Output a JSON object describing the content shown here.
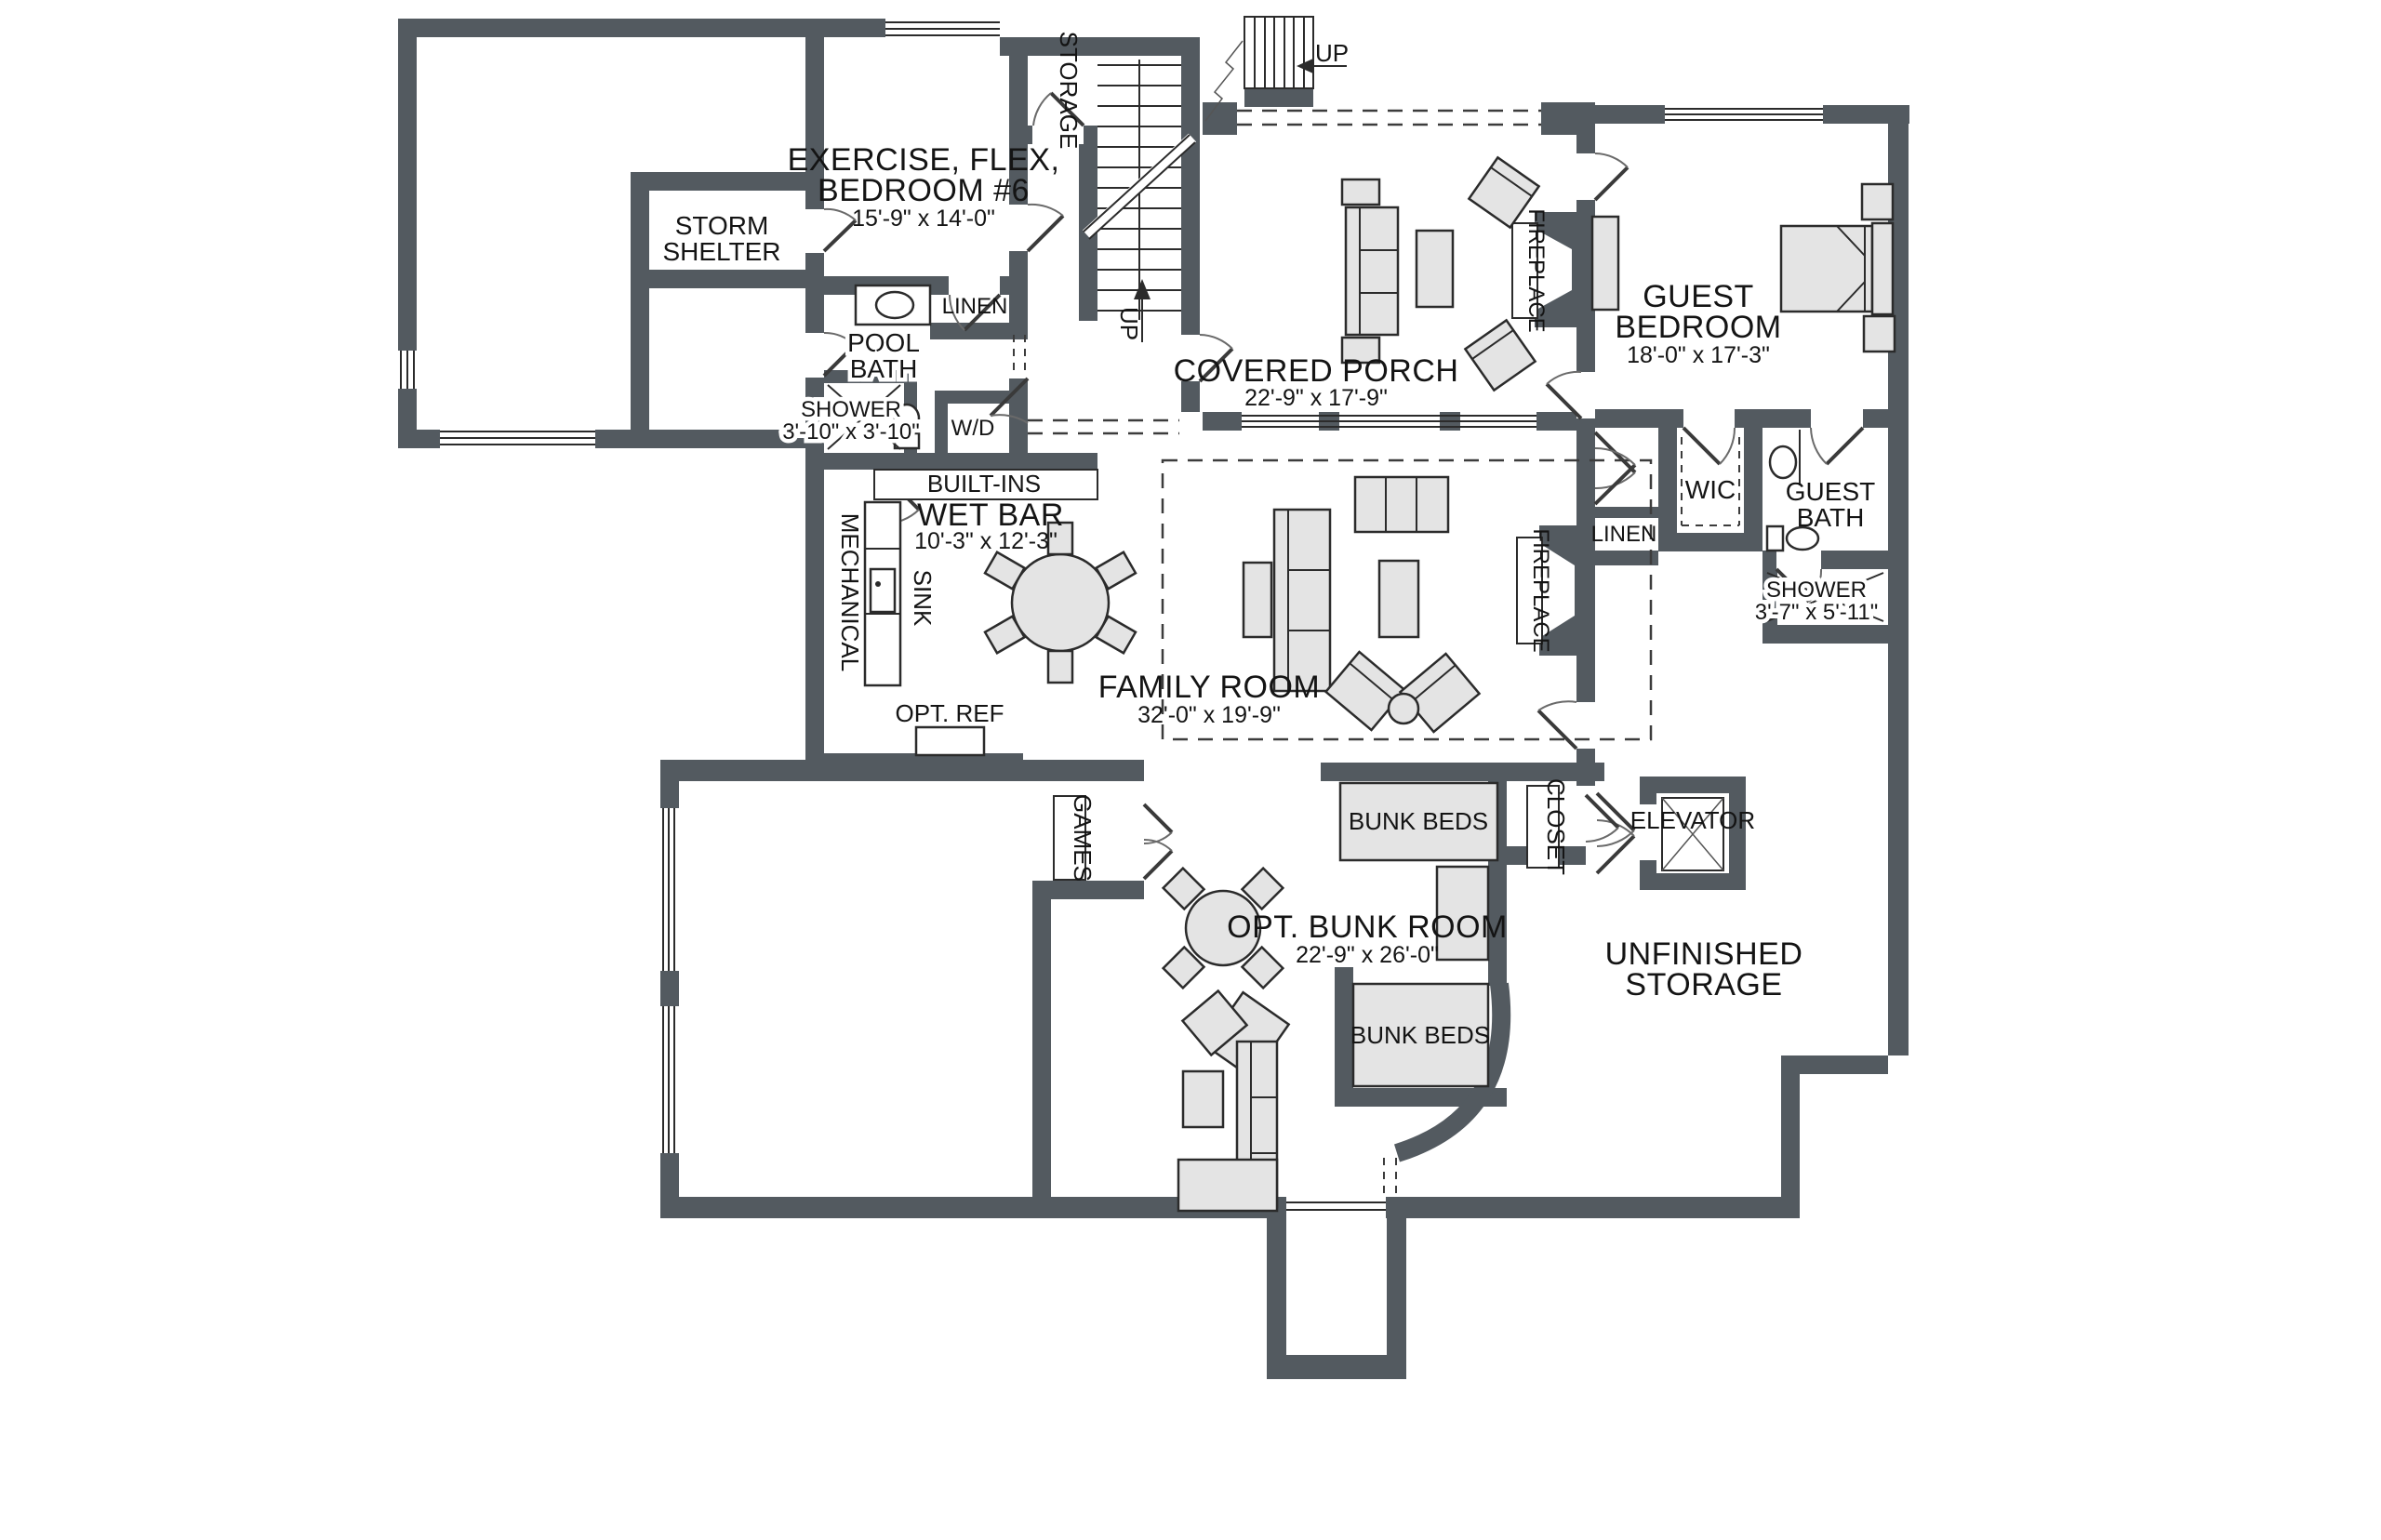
{
  "labels": {
    "exercise": {
      "l1": "EXERCISE, FLEX,",
      "l2": "BEDROOM #6",
      "dims": "15'-9\" x 14'-0\""
    },
    "storm": {
      "l1": "STORM",
      "l2": "SHELTER"
    },
    "storage_closet": "STORAGE",
    "up_interior": "UP",
    "up_exterior": "UP",
    "pool_bath": {
      "l1": "POOL",
      "l2": "BATH"
    },
    "linen_pool": "LINEN",
    "shower_pool": {
      "name": "SHOWER",
      "dims": "3'-10\" x 3'-10\""
    },
    "wd": "W/D",
    "built_ins": "BUILT-INS",
    "wet_bar": {
      "name": "WET BAR",
      "dims": "10'-3\" x 12'-3\""
    },
    "mechanical": "MECHANICAL",
    "sink": "SINK",
    "opt_ref": "OPT. REF",
    "covered_porch": {
      "name": "COVERED PORCH",
      "dims": "22'-9\" x 17'-9\""
    },
    "fireplace_porch": "FIREPLACE",
    "fireplace_family": "FIREPLACE",
    "guest_bedroom": {
      "l1": "GUEST",
      "l2": "BEDROOM",
      "dims": "18'-0\" x 17'-3\""
    },
    "wic": "WIC",
    "linen_guest": "LINEN",
    "guest_bath": {
      "l1": "GUEST",
      "l2": "BATH"
    },
    "shower_guest": {
      "name": "SHOWER",
      "dims": "3'-7\" x 5'-11\""
    },
    "family_room": {
      "name": "FAMILY ROOM",
      "dims": "32'-0\" x 19'-9\""
    },
    "games": "GAMES",
    "bunk_top": "BUNK BEDS",
    "closet_bunk": "CLOSET",
    "elevator": "ELEVATOR",
    "opt_bunk": {
      "name": "OPT. BUNK ROOM",
      "dims": "22'-9\" x 26'-0\""
    },
    "bunk_bottom": "BUNK BEDS",
    "unfinished": {
      "l1": "UNFINISHED",
      "l2": "STORAGE"
    }
  },
  "colors": {
    "wall": "#535a60",
    "furniture": "#e4e4e4",
    "line": "#1e1e1e",
    "background": "#ffffff"
  }
}
